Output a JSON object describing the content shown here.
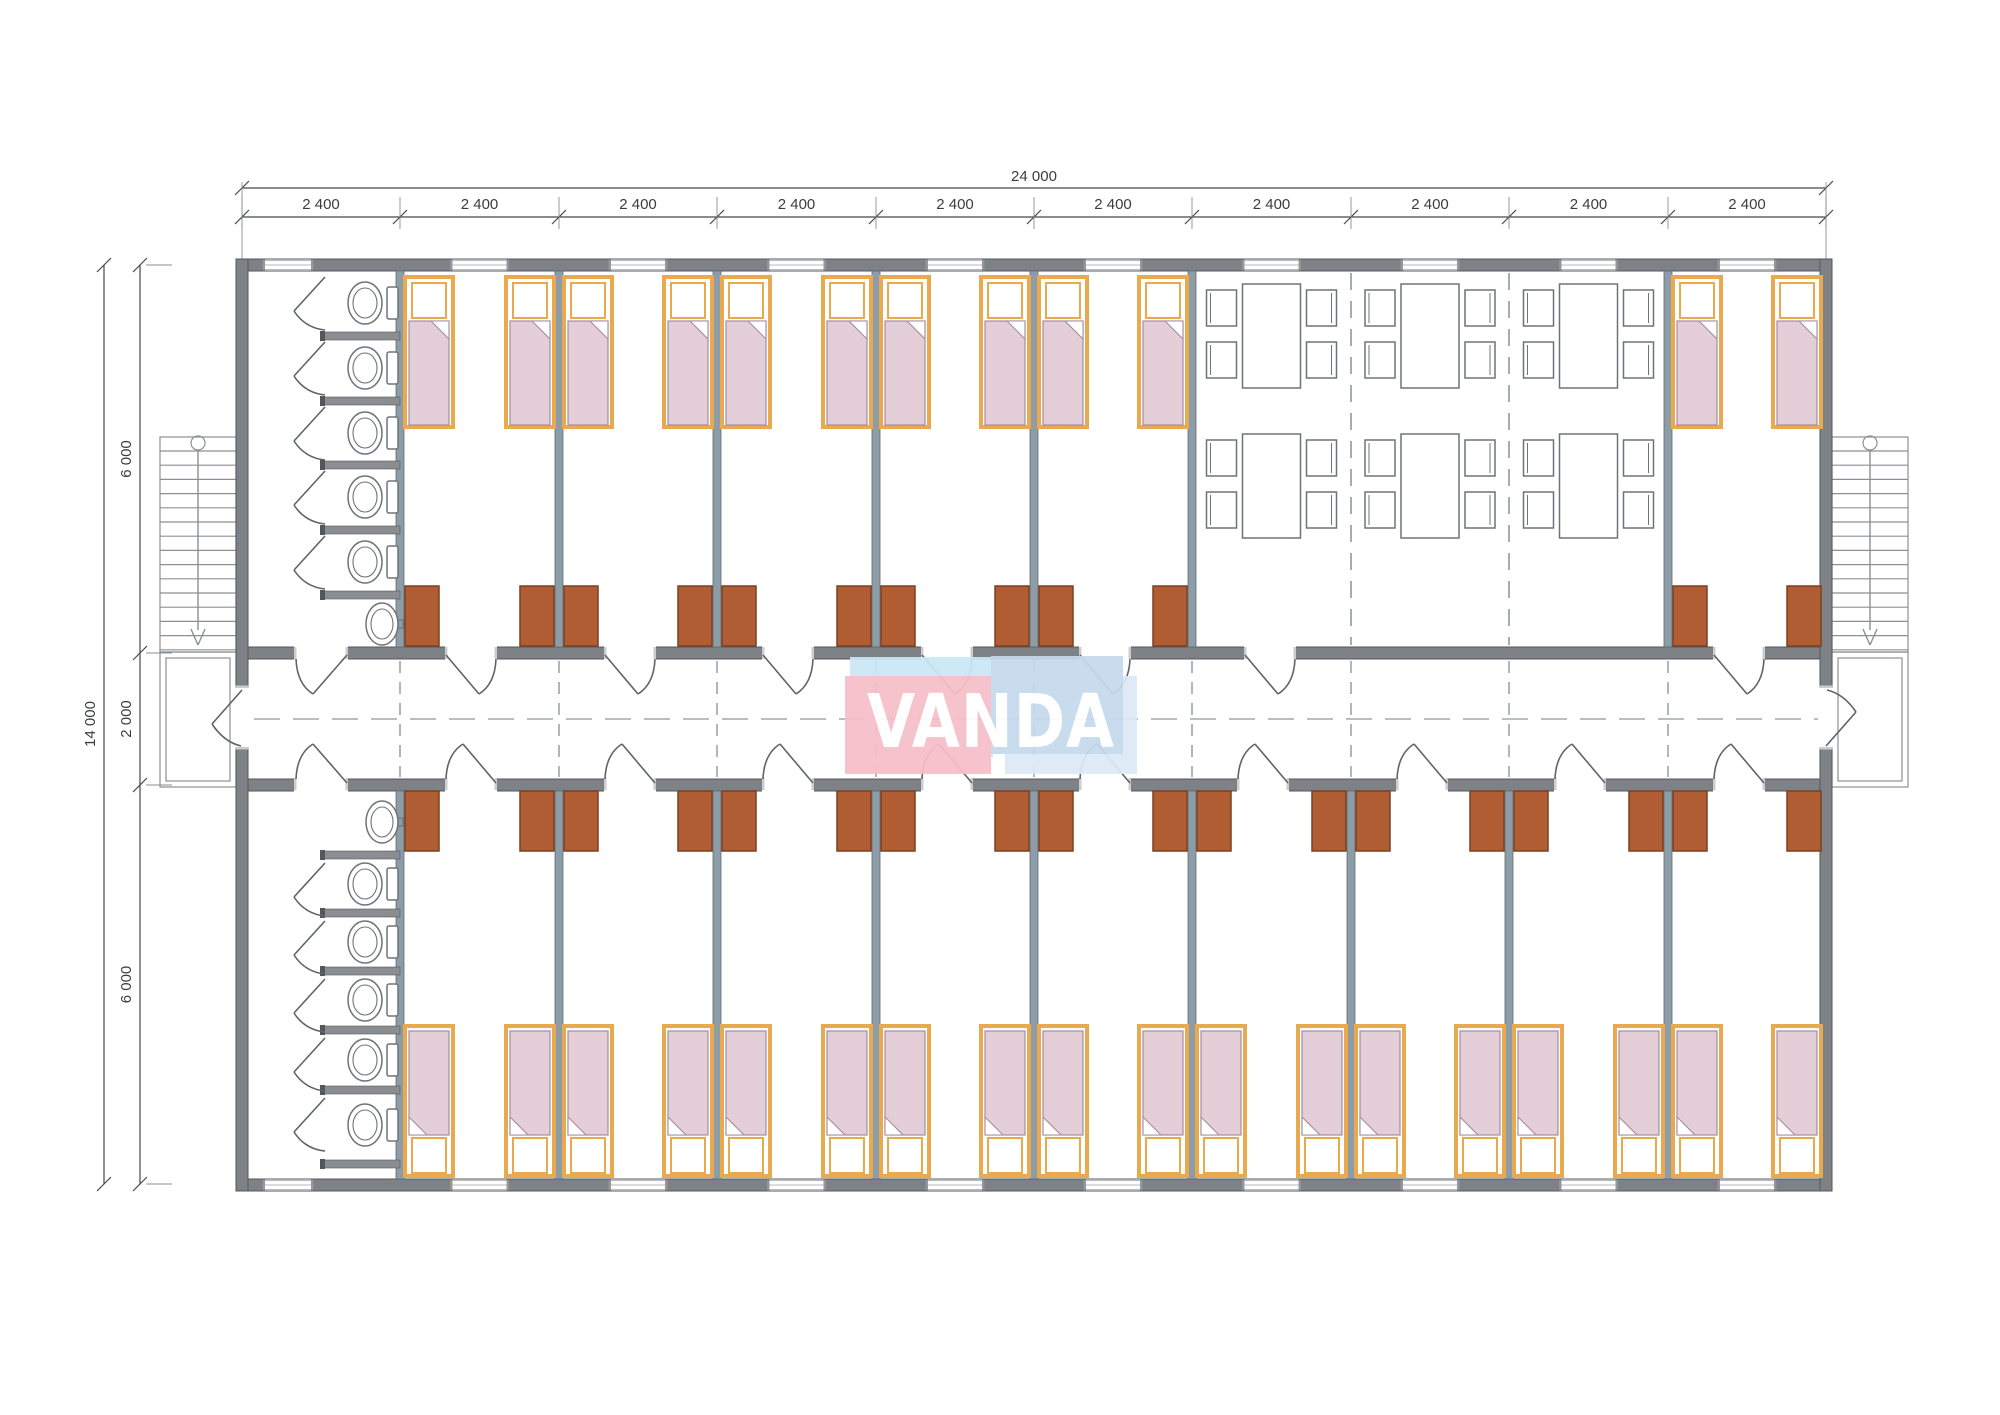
{
  "dimensions": {
    "top_total": "24 000",
    "top_segments": [
      "2 400",
      "2 400",
      "2 400",
      "2 400",
      "2 400",
      "2 400",
      "2 400",
      "2 400",
      "2 400",
      "2 400"
    ],
    "left_total": "14 000",
    "left_segments": [
      "6 000",
      "2 000",
      "6 000"
    ]
  },
  "logo": {
    "text": "VANDA",
    "pink": "#F6BFC9",
    "pink_shadow": "#CBE7F5",
    "blue": "#C5DAEC",
    "blue_shadow": "#DCEAF6",
    "letter_color": "#FFFFFF"
  },
  "floorplan": {
    "top_wing_modules": [
      "washroom",
      "bedroom",
      "bedroom",
      "bedroom",
      "bedroom",
      "bedroom",
      "dining",
      "dining",
      "dining",
      "bedroom"
    ],
    "bottom_wing_modules": [
      "washroom",
      "bedroom",
      "bedroom",
      "bedroom",
      "bedroom",
      "bedroom",
      "bedroom",
      "bedroom",
      "bedroom",
      "bedroom"
    ],
    "counts": {
      "modules_per_wing": 10,
      "washrooms": 2,
      "toilets_per_washroom": 5,
      "sinks": 2,
      "dining_tables": 6,
      "chairs_per_table": 4,
      "beds": 30,
      "wardrobes": 30,
      "staircases": 2,
      "corridor_room_doors": 18,
      "entrance_doors": 2,
      "windows": 20
    }
  },
  "colors": {
    "background": "#FFFFFF",
    "wall": "#7E8286",
    "wall_outline": "#54575A",
    "partition": "#8C9DA7",
    "partition_outline": "#5E6B73",
    "stall": "#8A8E92",
    "fixture": "#6F7377",
    "door": "#5F6367",
    "dash": "#90979C",
    "dim_line": "#45484B",
    "dim_text": "#3A3D40",
    "bed_frame": "#E9A94E",
    "blanket": "#E4CFD8",
    "blanket_outline": "#A78BA0",
    "wardrobe": "#B05D33",
    "wardrobe_outline": "#7A4122",
    "window_glaze": "#B6BABD",
    "window_jamb": "#93979A",
    "opening_cap": "#C9CDD0",
    "stairs": "#8B9094"
  }
}
